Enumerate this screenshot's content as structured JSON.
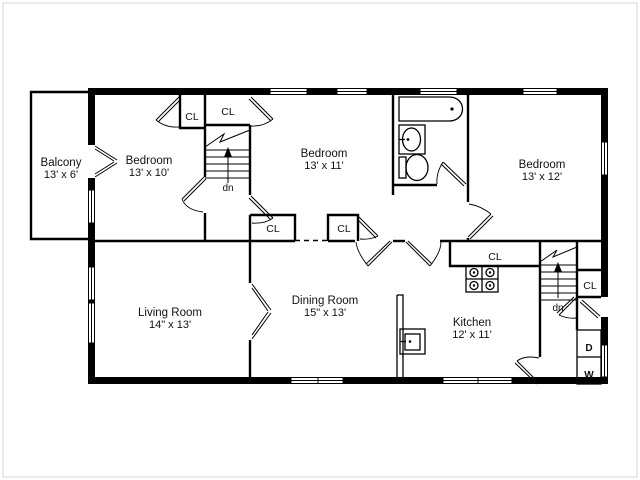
{
  "diagram": {
    "type": "residential floor plan",
    "background": "#ffffff",
    "wall_color": "#000000",
    "border_color": "#d9d9d9"
  },
  "rooms": {
    "balcony": {
      "name": "Balcony",
      "dims": "13' x 6'"
    },
    "bedroom_left": {
      "name": "Bedroom",
      "dims": "13' x 10'"
    },
    "bedroom_middle": {
      "name": "Bedroom",
      "dims": "13' x 11'"
    },
    "bedroom_right": {
      "name": "Bedroom",
      "dims": "13' x 12'"
    },
    "living_room": {
      "name": "Living Room",
      "dims": "14\" x 13'"
    },
    "dining_room": {
      "name": "Dining Room",
      "dims": "15\" x 13'"
    },
    "kitchen": {
      "name": "Kitchen",
      "dims": "12' x 11'"
    }
  },
  "labels": {
    "closet": "CL",
    "stairs_down": "dn",
    "dryer": "D",
    "washer": "W"
  }
}
